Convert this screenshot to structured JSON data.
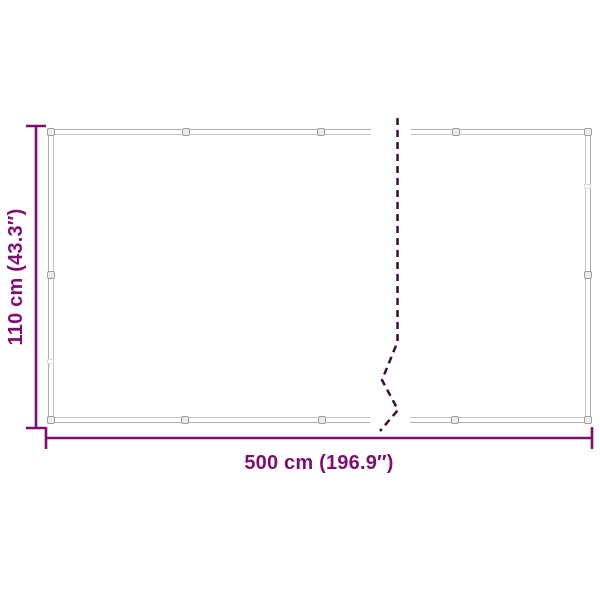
{
  "labels": {
    "height": "110 cm (43.3″)",
    "width": "500 cm (196.9″)"
  },
  "colors": {
    "background": "#ffffff",
    "dimension": "#7e0f72",
    "break_line": "#3f0c35",
    "frame_outer": "#adadad",
    "frame_inner": "#c6c6c6",
    "grommet_stroke": "#a0a0a0",
    "grommet_fill": "#ebebeb",
    "seam": "#d8d8d8"
  }
}
